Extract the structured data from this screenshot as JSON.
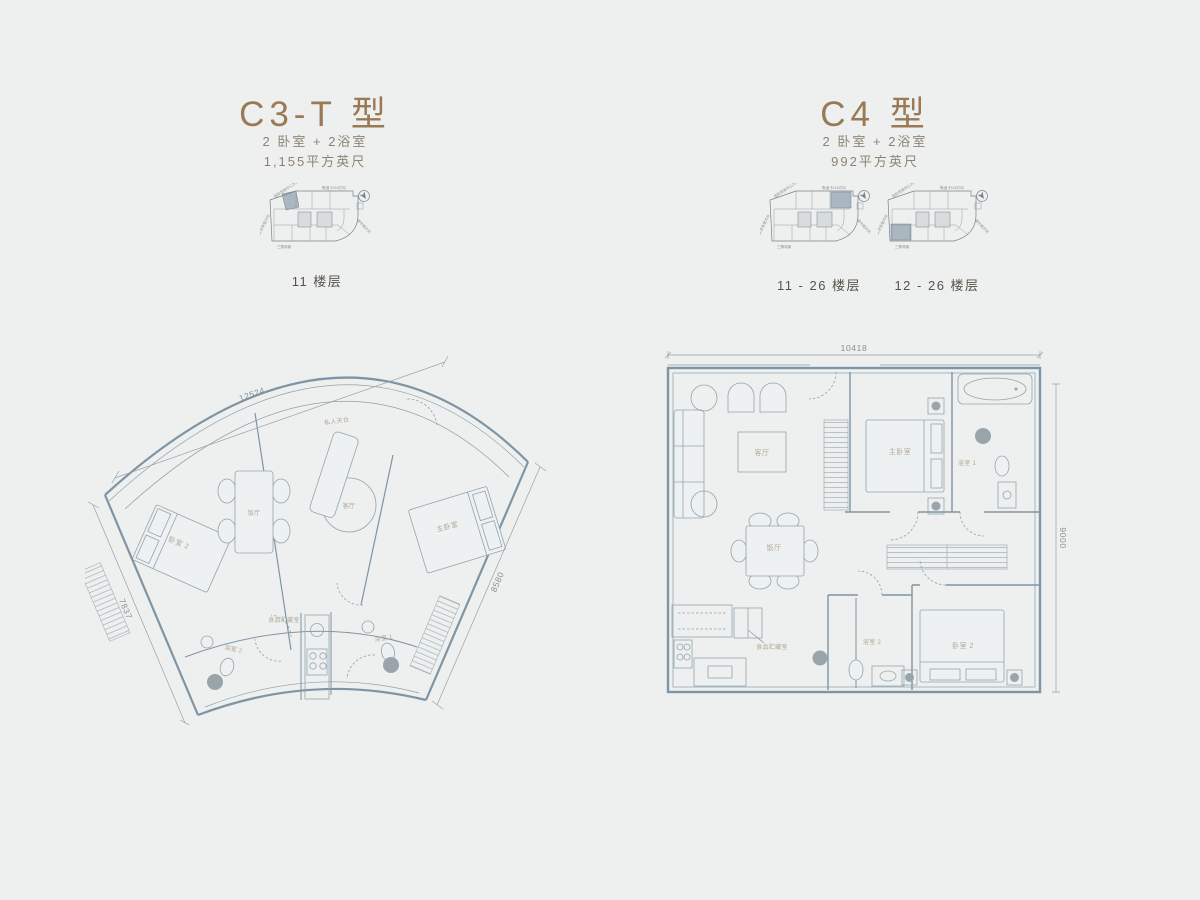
{
  "page": {
    "background": "#edf0ee"
  },
  "palette": {
    "accent_brown": "#9a7a55",
    "subtitle_gray": "#8d8375",
    "caption_gray": "#57544b",
    "plan_line": "#7f94a4",
    "wall_fill": "#b7c4cd",
    "highlight_block": "#aab7c0"
  },
  "units": {
    "c3t": {
      "title": "C3-T 型",
      "spec_line": "2 卧室 + 2浴室",
      "area_line": "1,155平方英尺",
      "keyplan_caption": "11 楼层",
      "dimensions": {
        "top": "12524",
        "left": "7837",
        "right": "8580"
      },
      "rooms": {
        "terrace": "私人天台",
        "bedroom2": "卧室 2",
        "dining": "饭厅",
        "living": "客厅",
        "master": "主卧室",
        "bath2": "浴室 2",
        "pantry": "食品贮藏室",
        "bath1": "浴室 1"
      }
    },
    "c4": {
      "title": "C4 型",
      "spec_line": "2 卧室 + 2浴室",
      "area_line": "992平方英尺",
      "keyplan_captions": [
        "11 - 26 楼层",
        "12 - 26 楼层"
      ],
      "dimensions": {
        "top": "10418",
        "right": "9000"
      },
      "rooms": {
        "living": "客厅",
        "master": "主卧室",
        "bath1": "浴室 1",
        "dining": "饭厅",
        "pantry": "食品贮藏室",
        "bath2": "浴室 2",
        "bedroom2": "卧室 2"
      }
    }
  },
  "keyplan": {
    "labels": {
      "top_left": "国际贸易中心方向",
      "top_right": "默迪卡118方向",
      "left": "武吉免登方向",
      "right": "城中城方向",
      "bottom": "三藩湾景"
    }
  }
}
